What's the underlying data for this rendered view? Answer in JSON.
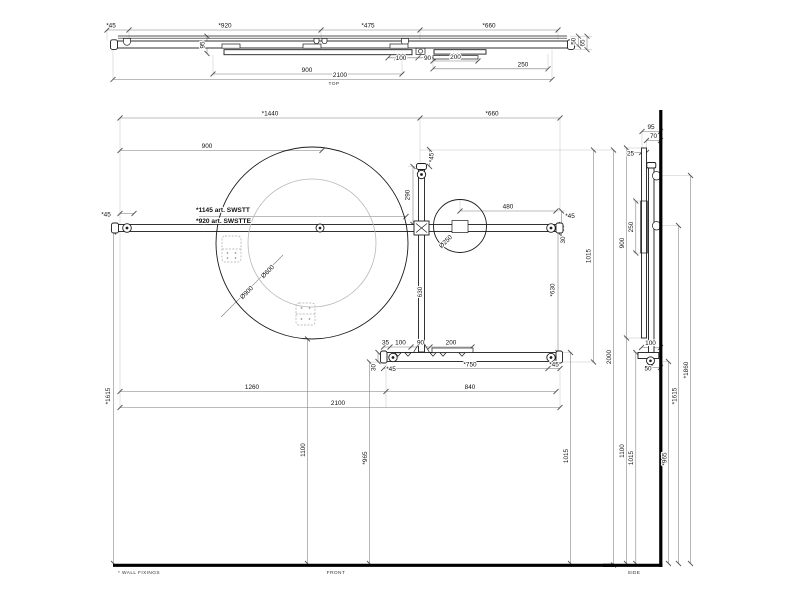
{
  "footnote": "* WALL FIXINGS",
  "colors": {
    "ink": "#1c1c1c",
    "dimension": "#7a7a7a",
    "extension": "#c6c6c6",
    "wall": "#000000"
  },
  "views": {
    "top": {
      "label": "TOP",
      "dims": {
        "d45": "*45",
        "d920": "*920",
        "d475": "*475",
        "d660": "*660",
        "d50": "50",
        "d65": "65",
        "d95": "95",
        "d100": "100",
        "d90": "90",
        "d200": "200",
        "d250": "250",
        "d900": "900",
        "d2100": "2100"
      }
    },
    "front": {
      "label": "FRONT",
      "note1": "*1145 art. SWSTT",
      "note2": "*920 art. SWSTTE",
      "dims": {
        "d1440": "*1440",
        "d660": "*660",
        "d900": "900",
        "d45_left": "*45",
        "dia900": "Ø900",
        "dia600": "Ø600",
        "dia250": "Ø250",
        "d45_bar": "*45",
        "d290": "290",
        "d480": "480",
        "d45_right": "*45",
        "d30_right": "30",
        "d1015_upper": "1015",
        "d630_right": "*630",
        "d630_bar": "630",
        "d2000": "2000",
        "d35": "35",
        "d100": "100",
        "d90": "90",
        "d200": "200",
        "d30_shelf": "30",
        "d45_shelf_left": "*45",
        "d750": "*750",
        "d45_shelf_right": "*45",
        "d840": "840",
        "d1260": "1260",
        "d2100": "2100",
        "d1615": "*1615",
        "d1100": "1100",
        "d965": "*965",
        "d1015_lower": "1015"
      }
    },
    "side": {
      "label": "SIDE",
      "dims": {
        "d95": "95",
        "d70": "70",
        "d25": "25",
        "d900": "900",
        "d250": "250",
        "d100": "100",
        "d50": "50",
        "d1860": "*1860",
        "d1615": "*1615",
        "d1100": "1100",
        "d1015": "1015",
        "d965": "*965"
      }
    }
  }
}
